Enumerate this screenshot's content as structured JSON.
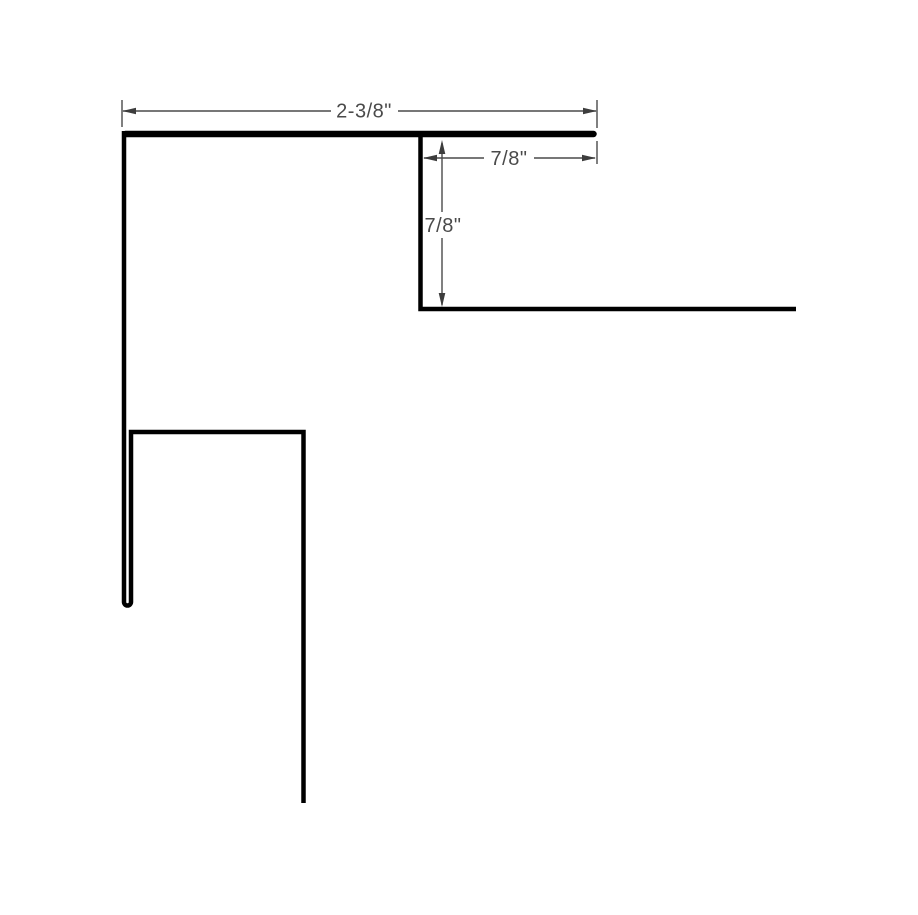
{
  "page": {
    "background": "#ffffff",
    "kind": "technical-dimension-drawing"
  },
  "diagram": {
    "subject": "hemmed-trim-profile-cross-section",
    "profile_color": "#000000",
    "dimension_color": "#4a4a4a",
    "dimensions": [
      {
        "id": "top-width",
        "label": "2-3/8\"",
        "value_inches": 2.375,
        "orientation": "horizontal"
      },
      {
        "id": "hem-return-width",
        "label": "7/8\"",
        "value_inches": 0.875,
        "orientation": "horizontal"
      },
      {
        "id": "return-drop-height",
        "label": "7/8\"",
        "value_inches": 0.875,
        "orientation": "vertical"
      }
    ]
  }
}
